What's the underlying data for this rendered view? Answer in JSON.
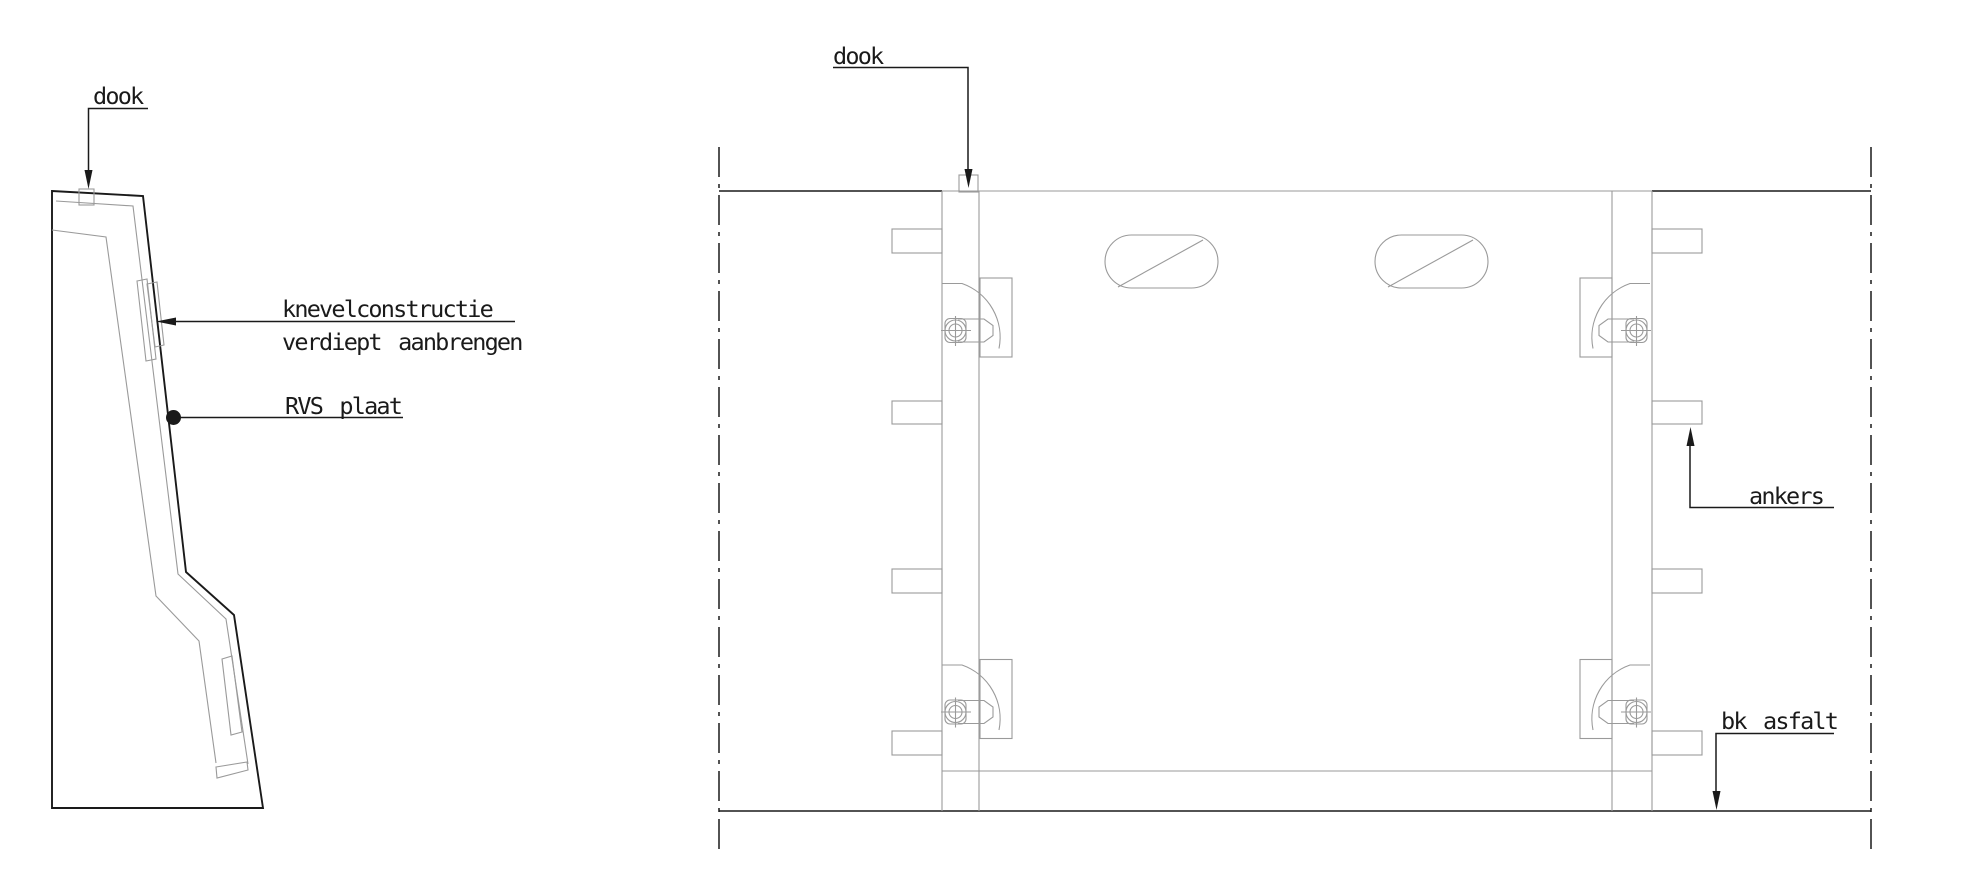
{
  "drawing": {
    "background": "#ffffff",
    "line_color": "#1a1a1a",
    "thin_line_color": "#9a9a9a",
    "left_view": {
      "labels": {
        "dook": "dook",
        "knevel_line1": "knevelconstructie",
        "knevel_line2": "verdiept aanbrengen",
        "rvs_plaat": "RVS plaat"
      }
    },
    "right_view": {
      "labels": {
        "dook": "dook",
        "ankers": "ankers",
        "bk_asfalt": "bk asfalt"
      }
    }
  }
}
